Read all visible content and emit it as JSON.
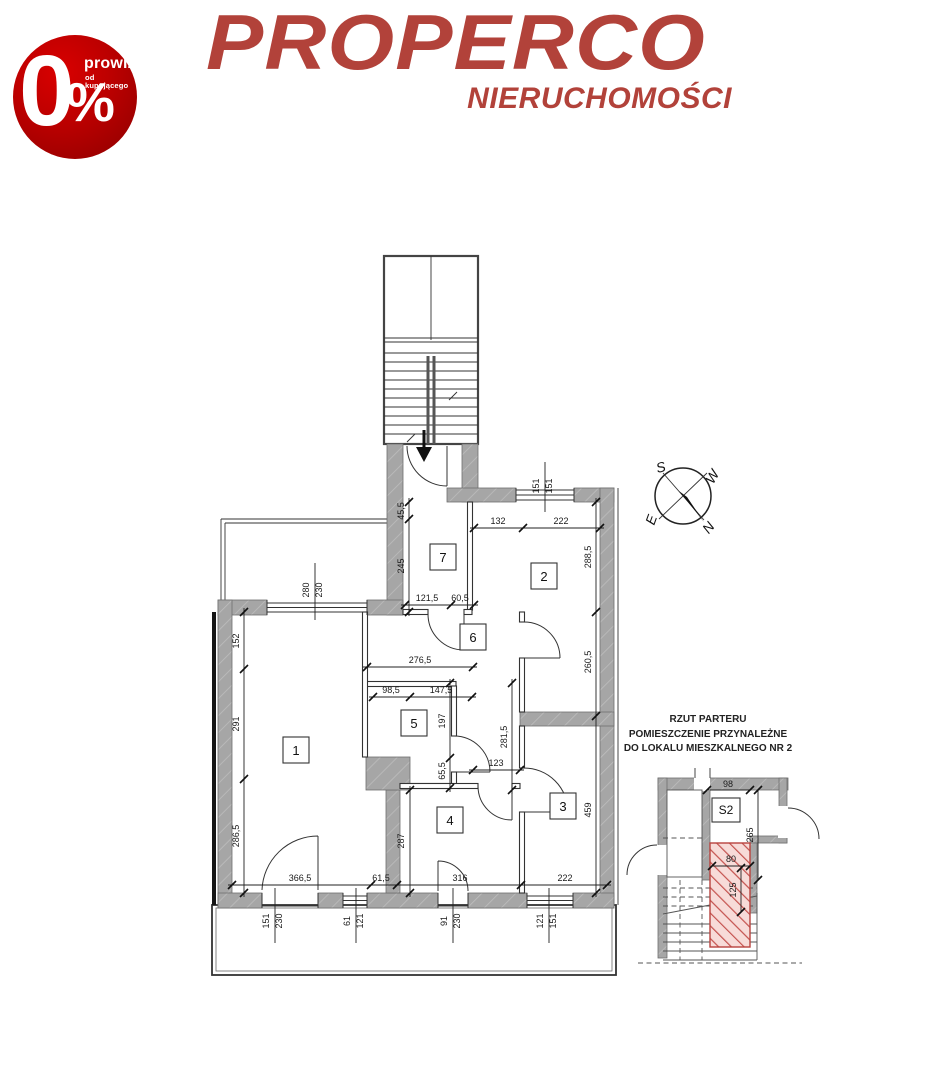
{
  "header": {
    "badge": {
      "zero": "0",
      "percent": "%",
      "line1": "prowizji",
      "line2": "od kupującego"
    },
    "logo_title": "PROPERCO",
    "logo_subtitle": "NIERUCHOMOŚCI"
  },
  "colors": {
    "brand_red": "#b2423a",
    "badge_red": "#c40000",
    "badge_red_dark": "#8c0000",
    "wall_gray": "#a6a6a6",
    "red_hatch": "#c4524e",
    "line_dark": "#333333"
  },
  "compass": {
    "n": "N",
    "s": "S",
    "w": "W",
    "e": "E"
  },
  "rooms": [
    "1",
    "2",
    "3",
    "4",
    "5",
    "6",
    "7"
  ],
  "dims": {
    "win_top_w": "151",
    "win_top_h": "151",
    "r2_top_left": "132",
    "r2_top_right": "222",
    "r2_right_upper": "288,5",
    "r2_right_lower": "260,5",
    "r3_right": "459",
    "r7_left_upper": "45,5",
    "r7_left_lower": "245",
    "r7_bottom_left": "121,5",
    "r7_bottom_right": "60,5",
    "r1_win_w": "280",
    "r1_win_h": "230",
    "r1_left_upper": "152",
    "r1_left_middle": "291",
    "r1_left_lower": "286,5",
    "r5_top": "276,5",
    "r5_inner_left": "98,5",
    "r5_inner_right": "147,5",
    "r5_right_upper": "197",
    "r5_right_lower": "65,5",
    "hall_width": "123",
    "hall_height": "281,5",
    "r4_left": "287",
    "bottom_r1": "366,5",
    "bottom_wall": "61,5",
    "bottom_r4": "316",
    "bottom_r3": "222",
    "win_b1_w": "151",
    "win_b1_h": "230",
    "win_b2_w": "61",
    "win_b2_h": "121",
    "win_b3_w": "91",
    "win_b3_h": "230",
    "win_b4_w": "121",
    "win_b4_h": "151"
  },
  "inset": {
    "title_line1": "RZUT PARTERU",
    "title_line2": "POMIESZCZENIE PRZYNALEŻNE",
    "title_line3": "DO LOKALU MIESZKALNEGO NR 2",
    "room_label": "S2",
    "dim_width": "98",
    "dim_height": "265",
    "dim_inner_width": "80",
    "dim_inner_height": "125"
  }
}
